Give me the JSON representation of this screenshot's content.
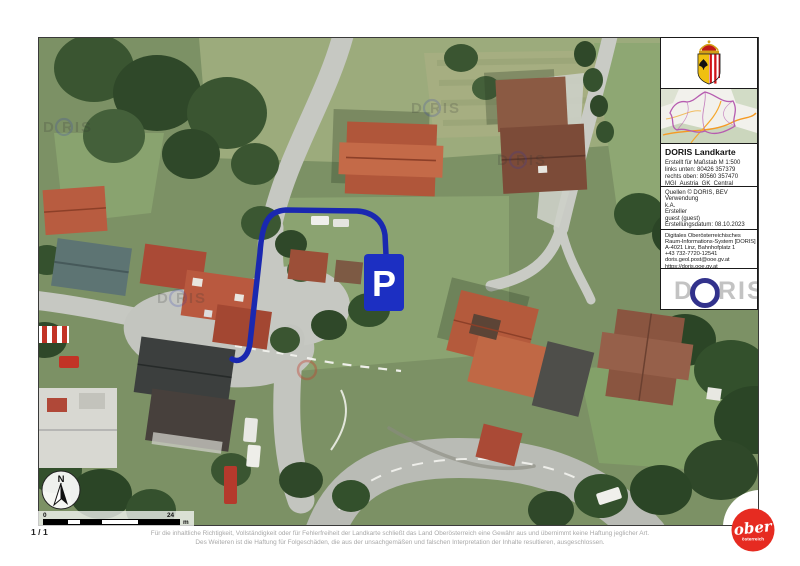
{
  "page": {
    "page_number": "1 / 1"
  },
  "sidebar": {
    "title": "DORIS Landkarte",
    "meta_lines": [
      "Erstellt für Maßstab M 1:500",
      "links unten: 80426 357379",
      "rechts oben: 80560 357470",
      "MGI_Austria_GK_Central"
    ],
    "source_lines": [
      "Quellen © DORIS, BEV",
      "Verwendung",
      "k.A.",
      "Ersteller",
      "guest (guest)",
      "Erstellungsdatum: 08.10.2023"
    ],
    "contact_lines": [
      "Digitales Oberösterreichisches",
      "Raum-Informations-System [DORIS]",
      "A-4021 Linz, Bahnhofplatz 1",
      "+43 732-7720-12541",
      "doris.geol.post@ooe.gv.at",
      "https://doris.ooe.gv.at"
    ],
    "doris_logo": {
      "d": "D",
      "ris": "RIS"
    }
  },
  "map": {
    "marker_label": "P",
    "compass_label": "N",
    "watermark": "D RIS",
    "scale_bar": {
      "start": "0",
      "end": "24",
      "unit": "m"
    }
  },
  "footer": {
    "disclaimer_line1": "Für die inhaltliche Richtigkeit, Vollständigkeit oder für Fehlerfreiheit der Landkarte schließt das Land Oberösterreich eine Gewähr aus und übernimmt keine Haftung jeglicher Art.",
    "disclaimer_line2": "Des Weiteren ist die Haftung für Folgeschäden, die aus der unsachgemäßen und falschen Interpretation der Inhalte resultieren, ausgeschlossen."
  },
  "brand": {
    "ober": "ober",
    "oesterreich": "österreich"
  },
  "colors": {
    "annotation_blue": "#1a28b0",
    "marker_blue": "#1c2fc2",
    "brand_red": "#e62b21",
    "doris_logo_blue": "#32328c"
  }
}
